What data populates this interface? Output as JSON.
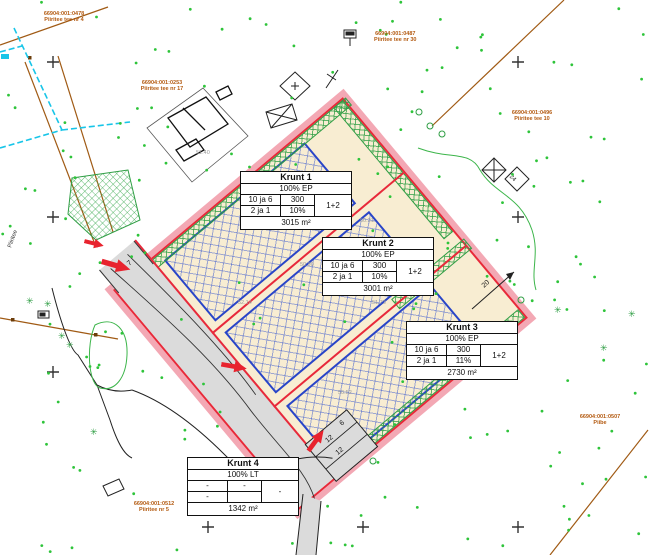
{
  "plots": [
    {
      "name": "Krunt 1",
      "use": "100% EP",
      "rows": [
        [
          "10 ja 6",
          "300",
          "1+2"
        ],
        [
          "2 ja 1",
          "10%",
          ""
        ]
      ],
      "area": "3015 m²"
    },
    {
      "name": "Krunt 2",
      "use": "100% EP",
      "rows": [
        [
          "10 ja 6",
          "300",
          "1+2"
        ],
        [
          "2 ja 1",
          "10%",
          ""
        ]
      ],
      "area": "3001 m²"
    },
    {
      "name": "Krunt 3",
      "use": "100% EP",
      "rows": [
        [
          "10 ja 6",
          "300",
          "1+2"
        ],
        [
          "2 ja 1",
          "11%",
          ""
        ]
      ],
      "area": "2730 m²"
    },
    {
      "name": "Krunt 4",
      "use": "100% LT",
      "rows": [
        [
          "-",
          "-",
          "-"
        ],
        [
          "-",
          "",
          ""
        ]
      ],
      "area": "1342 m²"
    }
  ],
  "dims": {
    "road_width": "7",
    "bay1": "12",
    "bay2": "12",
    "stub": "6",
    "k3_offset": "20",
    "house": "24"
  },
  "cadastral_labels": [
    {
      "line1": "66904:001:0478",
      "line2": "Piiritee tee nr 4"
    },
    {
      "line1": "66904:001:0253",
      "line2": "Piiritee tee nr 17"
    },
    {
      "line1": "66904:001:0487",
      "line2": "Piiritee tee nr 30"
    },
    {
      "line1": "66904:001:0496",
      "line2": "Piiritee tee 10"
    },
    {
      "line1": "66904:001:0507",
      "line2": "Piibe"
    },
    {
      "line1": "66904:001:0512",
      "line2": "Piiritee nr 5"
    }
  ],
  "road_label": "Piiritee",
  "spots": [
    {
      "value": "51.40"
    },
    {
      "value": "51.25"
    },
    {
      "value": "50.90"
    },
    {
      "value": "51.73"
    },
    {
      "value": "50.52"
    },
    {
      "value": "51.08"
    },
    {
      "value": "52.14"
    },
    {
      "value": "50.31"
    }
  ],
  "colors": {
    "boundary": "#e8293a",
    "boundary_halo": "#f3a8b4",
    "plot_fill": "#f8edd2",
    "building_envelope": "#2945c8",
    "vegetation": "#2f9e44",
    "road_fill": "#dbdbdb",
    "cadastral_line": "#a05a14",
    "water": "#18c5e8",
    "access_arrow": "#e8232e"
  }
}
